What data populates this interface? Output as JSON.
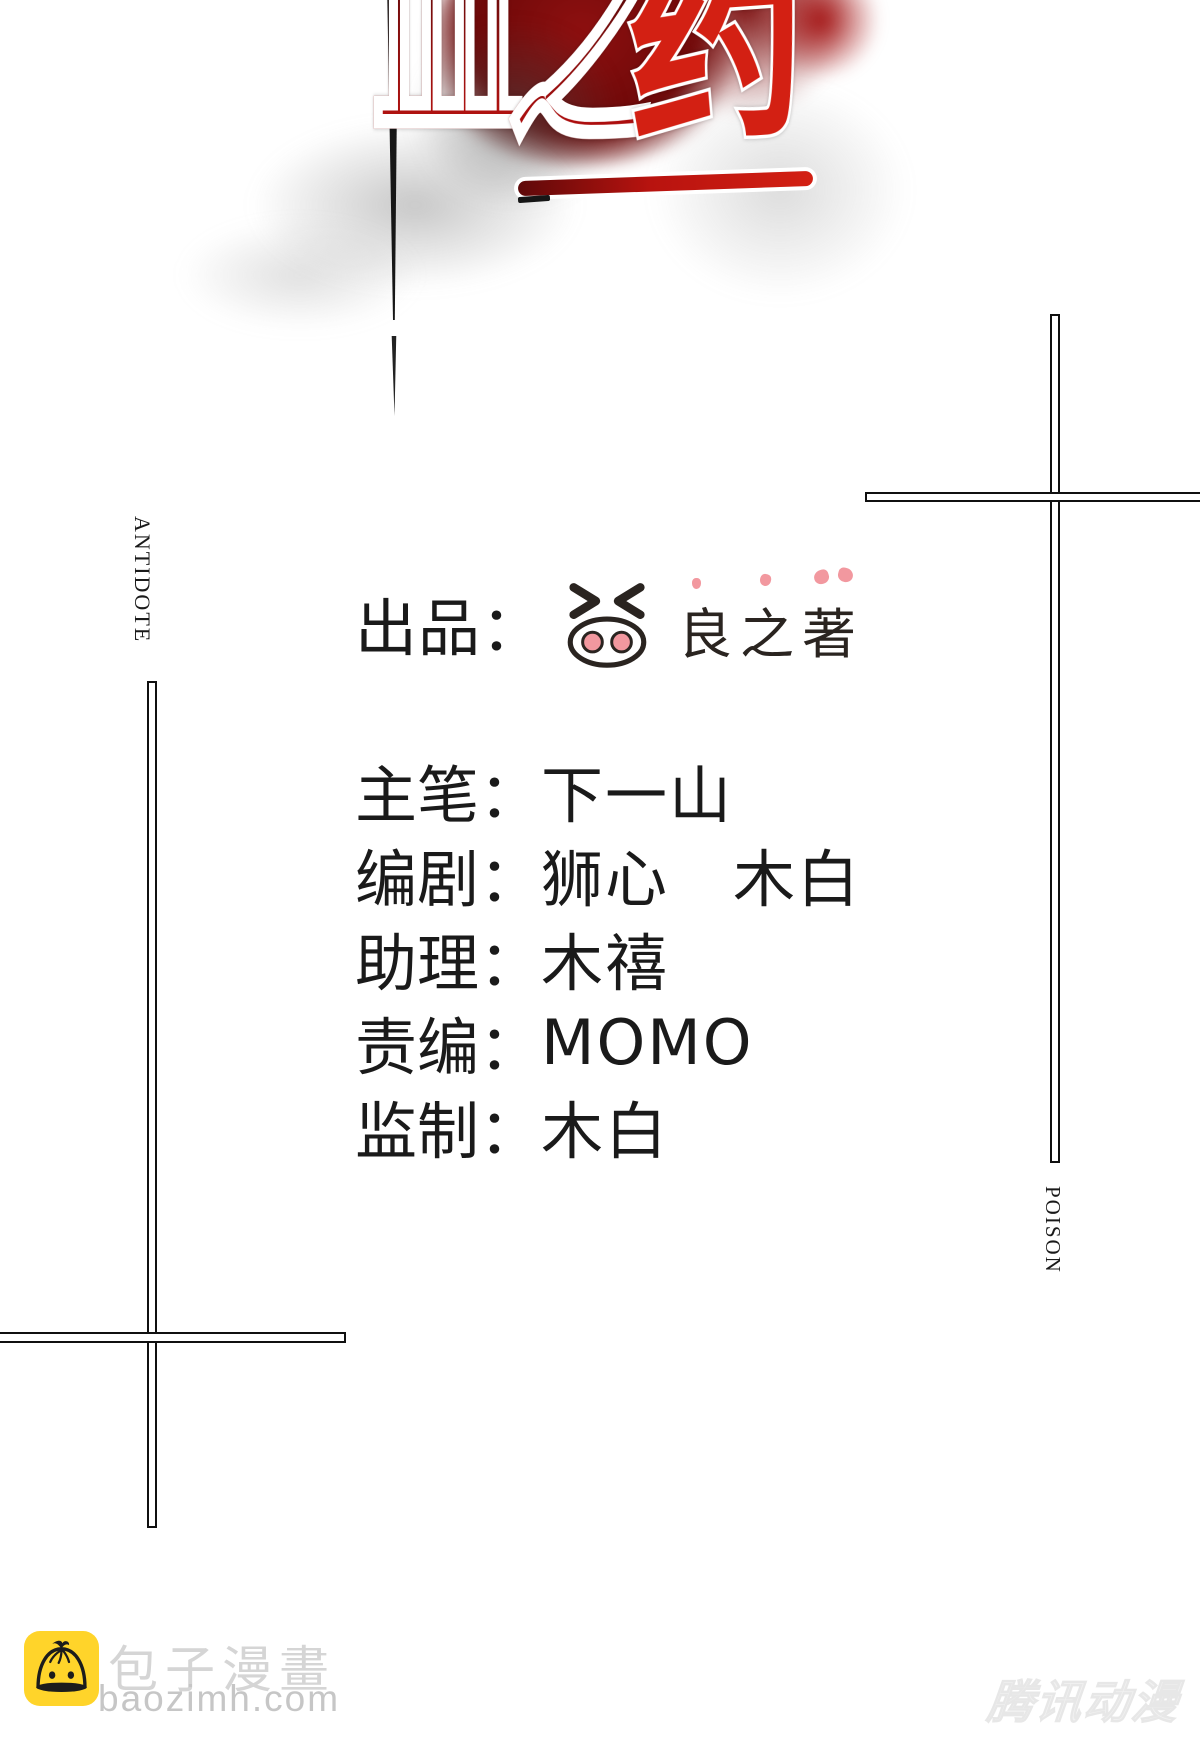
{
  "title": {
    "text": "血之药",
    "chars": [
      "血",
      "之",
      "药"
    ]
  },
  "side_labels": {
    "left": "ANTIDOTE",
    "right": "POISON"
  },
  "credits": {
    "producer_label": "出品：",
    "studio_name": "良之著",
    "rows": [
      {
        "label": "主笔：",
        "value": "下一山"
      },
      {
        "label": "编剧：",
        "value": "狮心　木白"
      },
      {
        "label": "助理：",
        "value": "木禧"
      },
      {
        "label": "责编：",
        "value": "MOMO"
      },
      {
        "label": "监制：",
        "value": "木白"
      }
    ]
  },
  "footer": {
    "site_name": "包子漫畫",
    "site_url": "baozimh.com",
    "watermark": "腾讯动漫"
  },
  "colors": {
    "title-red": "#d32013",
    "blood-dark": "#7a0d0d",
    "ink-black": "#161616",
    "text-black": "#1a1a1a",
    "logo-pink": "#f2989f",
    "logo-line": "#2a2420",
    "baozi-yellow": "#ffd42a",
    "footer-light": "#d5d5d5",
    "footer-gray": "#c6c6c6",
    "watermark-gray": "#f1f1f1"
  }
}
